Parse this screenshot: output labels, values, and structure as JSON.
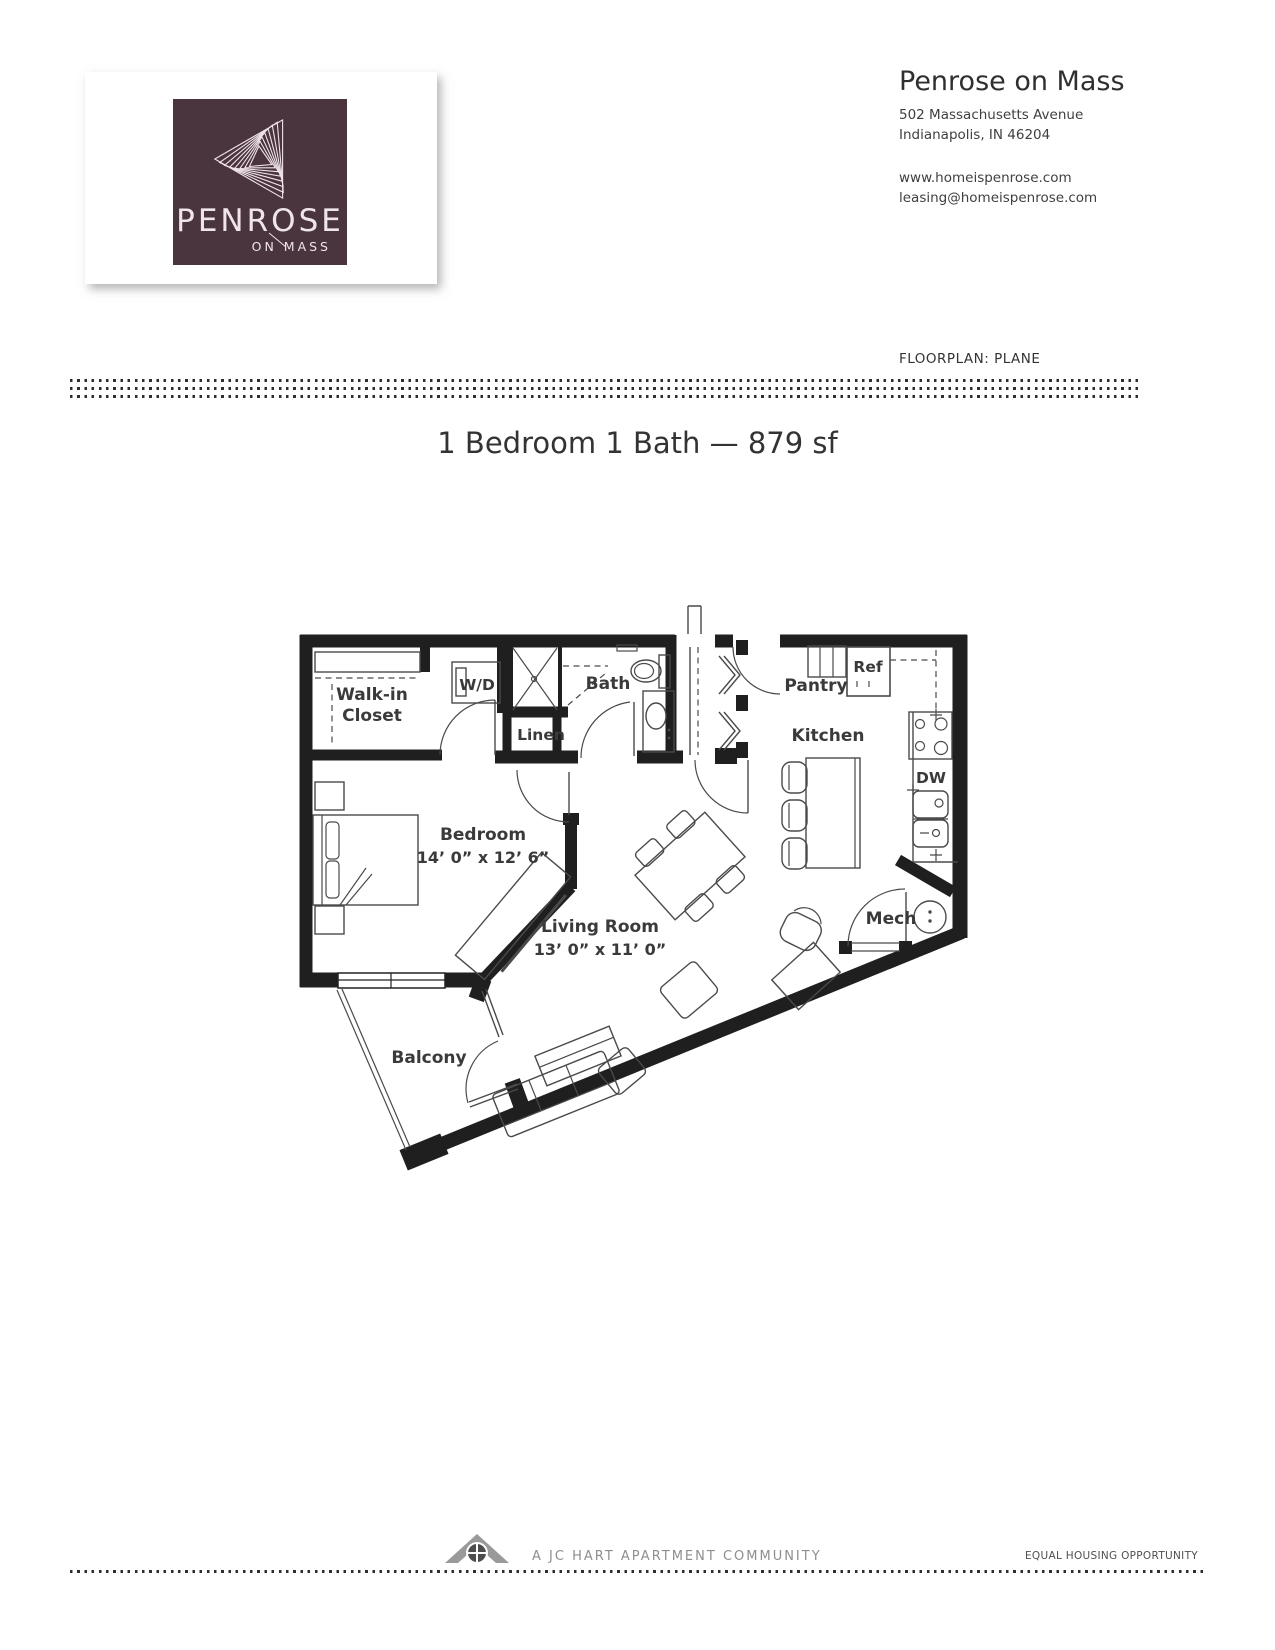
{
  "logo": {
    "brand": "PENROSE",
    "brand_sub": "ON MASS"
  },
  "header": {
    "company": "Penrose on Mass",
    "address_line1": "502 Massachusetts Avenue",
    "address_line2": "Indianapolis, IN 46204",
    "website": "www.homeispenrose.com",
    "email": "leasing@homeispenrose.com",
    "floorplan_label": "FLOORPLAN: PLANE"
  },
  "title": "1 Bedroom 1 Bath — 879 sf",
  "plan": {
    "rooms": {
      "walk_in_closet_1": "Walk-in",
      "walk_in_closet_2": "Closet",
      "washer_dryer": "W/D",
      "bath": "Bath",
      "linen": "Linen",
      "pantry": "Pantry",
      "refrigerator": "Ref",
      "kitchen": "Kitchen",
      "dishwasher": "DW",
      "bedroom": "Bedroom",
      "bedroom_dim": "14’ 0” x 12’ 6”",
      "living_room": "Living Room",
      "living_room_dim": "13’ 0” x 11’ 0”",
      "mech": "Mech",
      "balcony": "Balcony"
    }
  },
  "footer": {
    "community": "A JC HART APARTMENT COMMUNITY",
    "equal_housing": "EQUAL HOUSING OPPORTUNITY"
  },
  "colors": {
    "logo_background": "#4a343e",
    "logo_text": "#f0e5ea",
    "wall": "#1f1f1f",
    "furniture_line": "#4a4a4a",
    "label_text": "#3a3a3a",
    "footer_gray": "#8e8e8e"
  }
}
